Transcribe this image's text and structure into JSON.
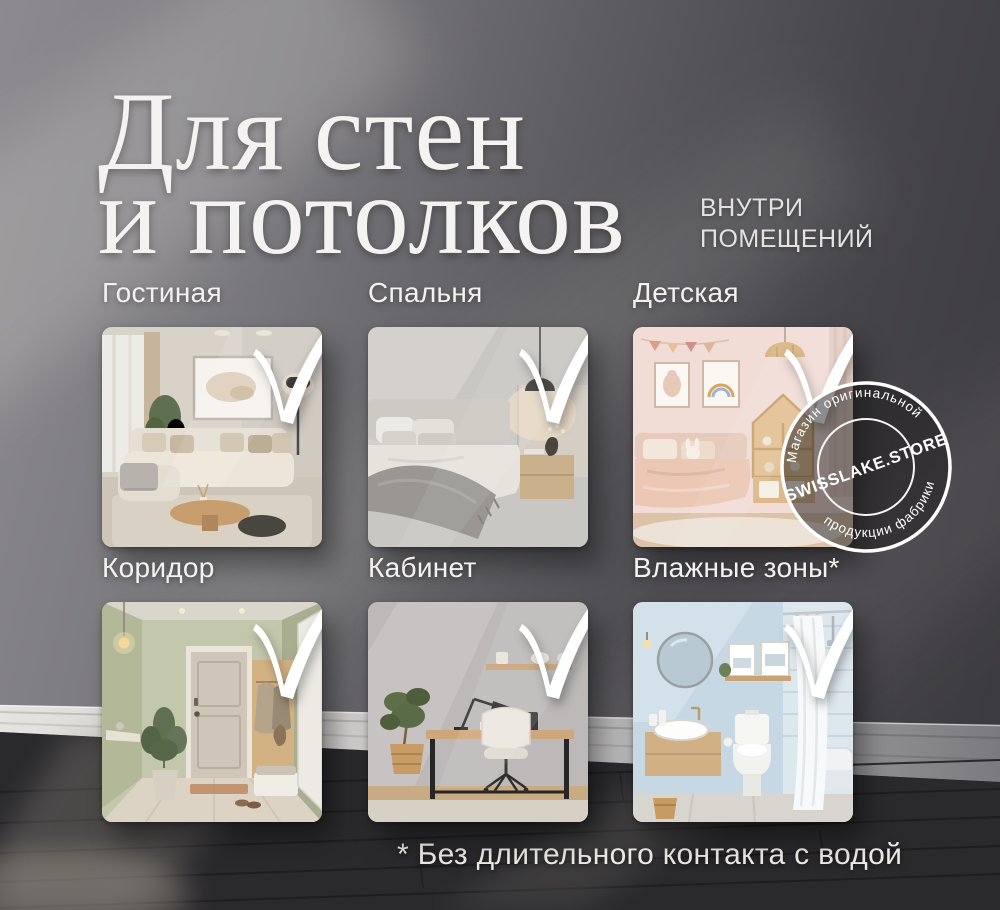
{
  "title": {
    "line1": "Для стен",
    "line2": "и потолков"
  },
  "subtitle": {
    "line1": "ВНУТРИ",
    "line2": "ПОМЕЩЕНИЙ"
  },
  "sections": [
    {
      "label": "Гостиная"
    },
    {
      "label": "Спальня"
    },
    {
      "label": "Детская"
    },
    {
      "label": "Коридор"
    },
    {
      "label": "Кабинет"
    },
    {
      "label": "Влажные зоны*"
    }
  ],
  "badge": {
    "arc_top": "Магазин оригинальной",
    "brand": "SWISSLAKE.STORE",
    "arc_bottom": "продукции фабрики"
  },
  "footnote": {
    "text": "* Без длительного контакта с водой"
  },
  "colors": {
    "wall_light": "#8d8b8f",
    "wall_dark": "#3a393d",
    "floor": "#2a292c",
    "baseboard": "#e3e1de",
    "text": "#f4f3f1",
    "checkmark": "#ffffff",
    "badge_ring": "#ffffff"
  }
}
